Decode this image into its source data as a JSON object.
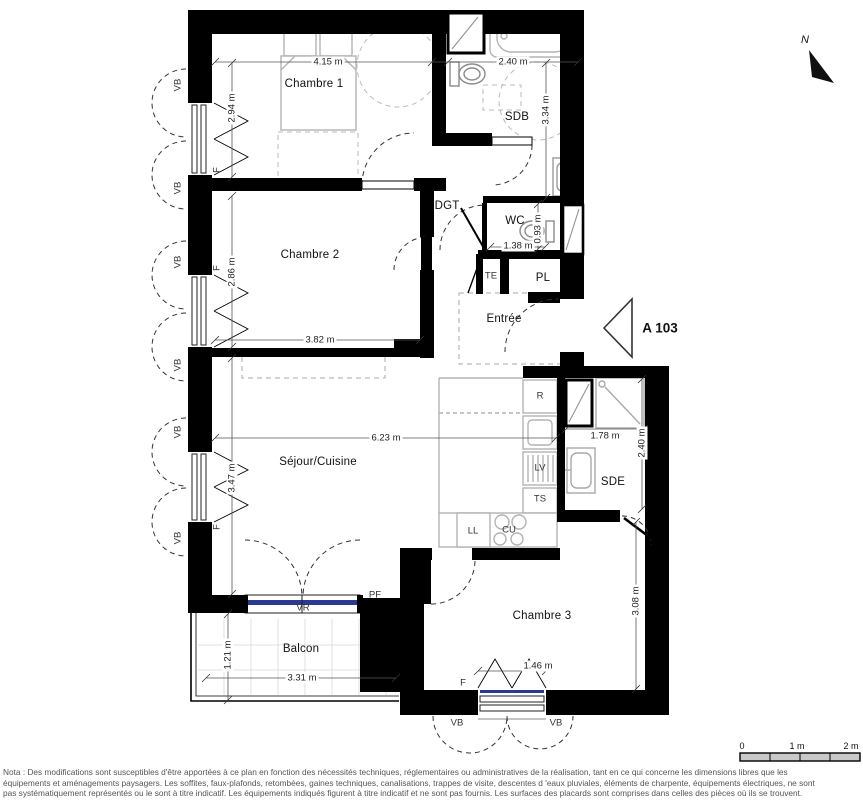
{
  "plan": {
    "unit": "A 103",
    "north": "N",
    "colors": {
      "wall": "#000000",
      "roller_shutter_bar": "#2b3990",
      "furniture": "#b3b3b3"
    },
    "rooms": {
      "chambre1": "Chambre 1",
      "chambre2": "Chambre 2",
      "chambre3": "Chambre 3",
      "sdb": "SDB",
      "wc": "WC",
      "dgt": "DGT",
      "te": "TE",
      "pl": "PL",
      "entree": "Entrée",
      "sejour": "Séjour/Cuisine",
      "sde": "SDE",
      "balcon": "Balcon"
    },
    "dimensions": {
      "chambre1_width": "4.15 m",
      "sdb_width": "2.40 m",
      "chambre1_height": "2.94 m",
      "sdb_height": "3.34 m",
      "chambre2_height": "2.86 m",
      "chambre2_width": "3.82 m",
      "wc_width": "1.38 m",
      "wc_height": "0.93 m",
      "sejour_width": "6.23 m",
      "sejour_height": "3.47 m",
      "sde_width": "1.78 m",
      "sde_height": "2.40 m",
      "chambre3_height": "3.08 m",
      "chambre3_width": "1.46 m",
      "balcon_height": "1.21 m",
      "balcon_width": "3.31 m"
    },
    "appliances": {
      "refrigerator": "R",
      "dishwasher": "LV",
      "ts": "TS",
      "washer": "LL",
      "cooktop": "CU"
    },
    "openings": {
      "casement_shutter": "VB",
      "window": "F",
      "french_window": "PF",
      "roller_shutter": "VR"
    },
    "scale_bar": {
      "start": "0",
      "mid": "1 m",
      "end": "2 m"
    },
    "nota_lines": [
      "Nota : Des modifications sont susceptibles d'être apportées à ce plan en fonction des nécessités techniques, réglementaires ou administratives de la réalisation, tant en ce qui concerne les dimensions libres que les",
      "équipements et aménagements paysagers. Les soffites, faux-plafonds, retombées, gaines techniques, canalisations, trappes de visite, descentes d 'eaux pluviales, éléments de charpente, équipements électriques, ne sont",
      "pas systématiquement représentés ou le sont à titre indicatif. Les équipements indiqués figurent à titre indicatif et ne sont pas fournis. Les surfaces des placards sont comprises dans celles des pièces où ils se trouvent."
    ]
  }
}
